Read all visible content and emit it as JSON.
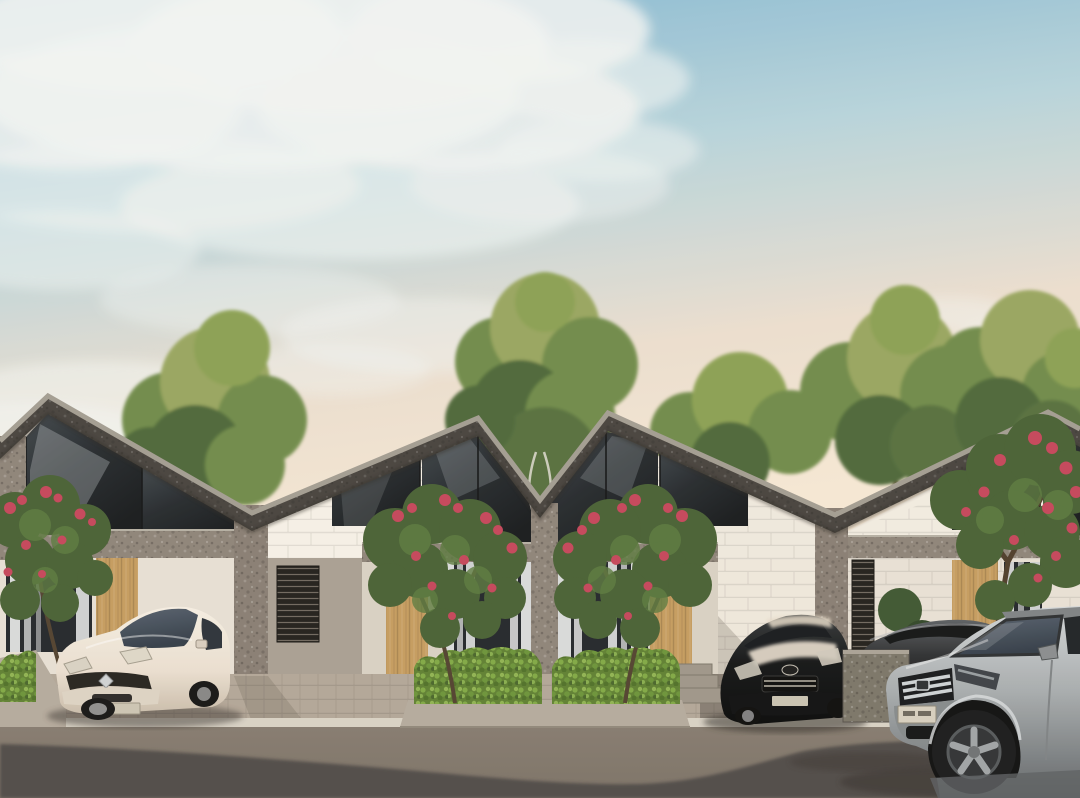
{
  "scene": {
    "title": "Modern minimalist row houses at golden hour",
    "caption": "Street-level architectural rendering of a row of modern gable houses with gravel-textured roofs, glass gable windows, white brick facades, timber slat doors, flowering frangipani trees, clipped hedges and four parked cars along an asphalt street at dusk.",
    "sky": {
      "condition": "soft cumulus clouds upper left, clear warm horizon",
      "time": "late afternoon"
    },
    "houses": [
      {
        "id": "house-1",
        "features": [
          "charcoal gravel mono-pitch roof",
          "glass gable with sky reflection",
          "white brick wall",
          "timber slat door",
          "sheer white curtains",
          "stone corner pillar"
        ]
      },
      {
        "id": "house-2",
        "features": [
          "steep gable roof",
          "full-height gable glazing",
          "white brick side wall",
          "timber slat door",
          "curtained window",
          "green hedge planter"
        ]
      },
      {
        "id": "house-3",
        "features": [
          "mirrored gable roof forming V valley",
          "full-height gable glazing",
          "timber slat door",
          "curtained window",
          "green hedge planter"
        ]
      },
      {
        "id": "house-4",
        "features": [
          "steep gable roof",
          "tall corner glazing",
          "white brick wall",
          "timber slat door",
          "dark louvre window",
          "stone gabion fence"
        ]
      }
    ],
    "vehicles": [
      {
        "id": "white-hatchback",
        "color_name": "cream white",
        "position": "parked in left driveway facing street"
      },
      {
        "id": "black-hatchback",
        "color_name": "glossy black with warm sky reflections",
        "position": "parked in right driveway facing street"
      },
      {
        "id": "gray-sedan",
        "color_name": "charcoal gray",
        "position": "parked behind gabion fence at right"
      },
      {
        "id": "silver-suv",
        "color_name": "silver gray",
        "position": "passing in right foreground, partially cropped"
      }
    ],
    "vegetation": [
      "tall yellow-green shade trees behind the roofline",
      "frangipani trees with crimson bloom clusters in front yards",
      "clipped bright green hedges in concrete planters"
    ],
    "street": {
      "surface": "asphalt with long soft building shadows",
      "curb": "light concrete curb",
      "paving": "light stone pavers and dark cobble driveways"
    }
  },
  "palette": {
    "sky_top": "#7fb5d1",
    "sky_mid": "#b7d4dd",
    "sky_warm": "#ecdfd0",
    "sky_horizon": "#f6e8d5",
    "cloud": "#f2f5f4",
    "roof": "#45413d",
    "roof_edge": "#a29c92",
    "glass_hi": "#3e454b",
    "glass_lo": "#15181b",
    "brick": "#efe9df",
    "brick_sun": "#f6f1e8",
    "wall_shade": "#a89f93",
    "stone": "#8d8379",
    "wood": "#c59b5e",
    "curtain": "#edeff0",
    "hedge": "#5d7f31",
    "flower": "#c5445a",
    "tree_light": "#97a55e",
    "tree_mid": "#6e8a49",
    "tree_dark": "#4b6638",
    "trunk": "#50402e",
    "planter": "#b4aa9d",
    "pavement": "#b2a698",
    "curb": "#d8d2c6",
    "road": "#7a7066",
    "road_shadow": "#4e4a46",
    "car_cream": "#eadfd1",
    "car_black": "#101214",
    "car_gray": "#2c2e31",
    "suv_silver": "#a6abae",
    "windshield": "#313b47"
  }
}
